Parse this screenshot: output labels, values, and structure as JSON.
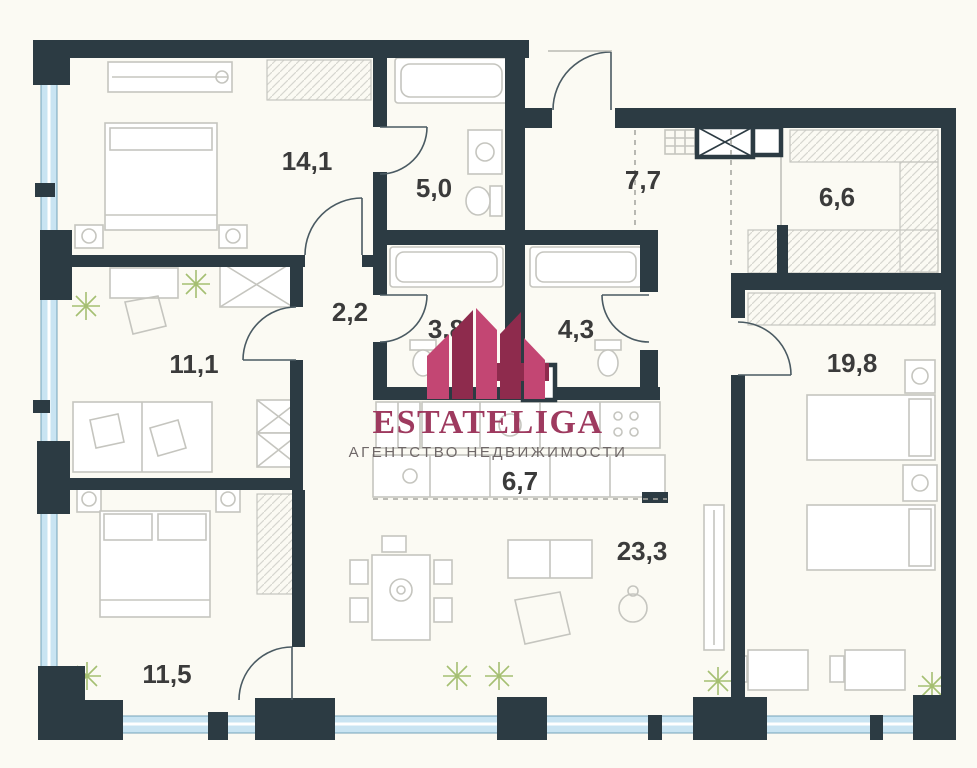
{
  "watermark": {
    "brand": "ESTATELIGA",
    "subtitle": "АГЕНТСТВО НЕДВИЖИМОСТИ"
  },
  "rooms": [
    {
      "id": "14-1",
      "label": "14,1",
      "x": 307,
      "y": 170
    },
    {
      "id": "5-0",
      "label": "5,0",
      "x": 434,
      "y": 197
    },
    {
      "id": "7-7",
      "label": "7,7",
      "x": 643,
      "y": 189
    },
    {
      "id": "6-6",
      "label": "6,6",
      "x": 837,
      "y": 206
    },
    {
      "id": "2-2",
      "label": "2,2",
      "x": 350,
      "y": 321
    },
    {
      "id": "3-8",
      "label": "3,8",
      "x": 446,
      "y": 338
    },
    {
      "id": "4-3",
      "label": "4,3",
      "x": 576,
      "y": 338
    },
    {
      "id": "11-1",
      "label": "11,1",
      "x": 194,
      "y": 373
    },
    {
      "id": "19-8",
      "label": "19,8",
      "x": 852,
      "y": 372
    },
    {
      "id": "6-7",
      "label": "6,7",
      "x": 520,
      "y": 490
    },
    {
      "id": "23-3",
      "label": "23,3",
      "x": 642,
      "y": 560
    },
    {
      "id": "11-5",
      "label": "11,5",
      "x": 167,
      "y": 683
    }
  ],
  "colors": {
    "wall": "#2c3b43",
    "window": "#c9e4f2",
    "window_frame": "#74a3ba",
    "furniture": "#c5c5bf",
    "hatch": "#d6d6d0",
    "door": "#4a5a62",
    "label": "#3b3b3b",
    "background": "#fbfaf3",
    "plant": "#a5bf72",
    "brand": "#9e3a5f",
    "subtitle": "#6f6868",
    "emblem_dark": "#8e2b4d",
    "emblem_bright": "#c34673"
  }
}
